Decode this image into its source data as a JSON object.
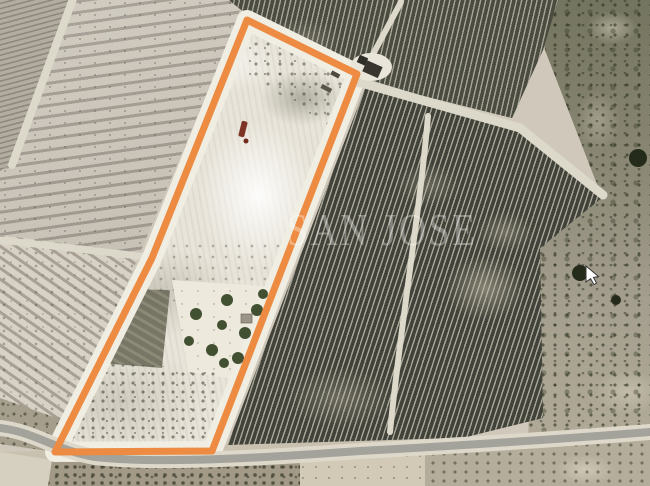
{
  "watermark": {
    "text": "SAN JOSE",
    "color": "rgba(255,255,255,0.35)"
  },
  "annotation": {
    "stroke_color": "#EC8B41",
    "halo_color": "#F0EDE2",
    "stroke_width": 7,
    "halo_width": 20,
    "polygon_points": [
      [
        247,
        20
      ],
      [
        357,
        74
      ],
      [
        212,
        451
      ],
      [
        55,
        452
      ],
      [
        152,
        258
      ]
    ]
  },
  "road": {
    "path": "M0,428 C35,432 55,450 95,457 C160,464 260,458 360,451 C470,445 560,439 650,432",
    "color": "#a3a29b",
    "casing_color": "#ddd8ca"
  },
  "tracks": {
    "color": "#dcd8ca",
    "top": "M358,82 L520,128 L603,195",
    "branch": "M371,58 L401,2",
    "vineyard_inner": "M428,116 C420,210 400,330 390,432",
    "divider_left": "M0,240 L148,257",
    "corner_divider": "M74,-4 L12,165"
  },
  "trees": {
    "olive_color": "#425032",
    "dark_color": "#242b1b",
    "parcel_olives": [
      [
        263,
        294,
        5
      ],
      [
        227,
        300,
        6
      ],
      [
        196,
        314,
        6
      ],
      [
        257,
        310,
        6
      ],
      [
        222,
        325,
        5
      ],
      [
        245,
        333,
        6
      ],
      [
        189,
        341,
        5
      ],
      [
        212,
        350,
        6
      ],
      [
        238,
        358,
        6
      ],
      [
        224,
        363,
        5
      ]
    ],
    "right_trees": [
      [
        638,
        158,
        9
      ],
      [
        580,
        273,
        8
      ],
      [
        616,
        300,
        5
      ]
    ]
  },
  "cursor": {
    "x": 586,
    "y": 266
  },
  "palette": {
    "vineyard_dark": "#434539",
    "terrace_field": "#c7c0b3",
    "parcel_light": "#e8e4d9",
    "scrub": "#8b8875",
    "road_gray": "#a3a29b"
  }
}
